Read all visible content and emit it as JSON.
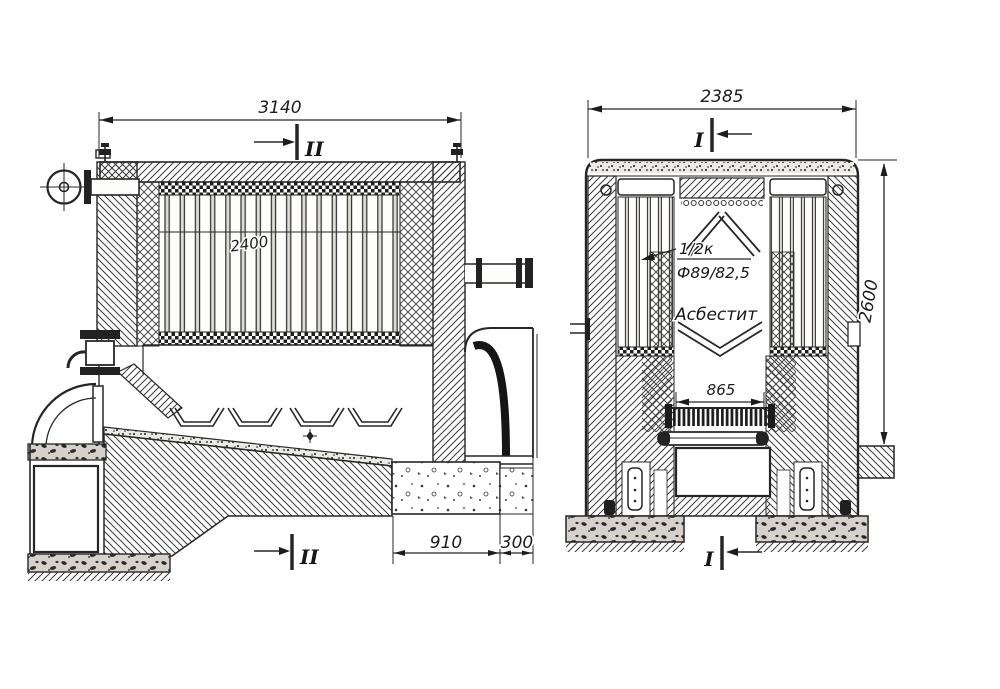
{
  "colors": {
    "ink": "#262626",
    "paper": "#ffffff"
  },
  "left_view": {
    "dim_top": "3140",
    "tube_label": "2400",
    "dim_foundation": "910",
    "dim_gap": "300",
    "section_top": "II",
    "section_bottom": "II"
  },
  "right_view": {
    "dim_top": "2385",
    "dim_height": "2600",
    "dim_grate": "865",
    "section_top": "I",
    "section_bottom": "I",
    "note_line1": "1/2к",
    "note_line2": "Ф89/82,5",
    "note_material": "Асбестит"
  }
}
